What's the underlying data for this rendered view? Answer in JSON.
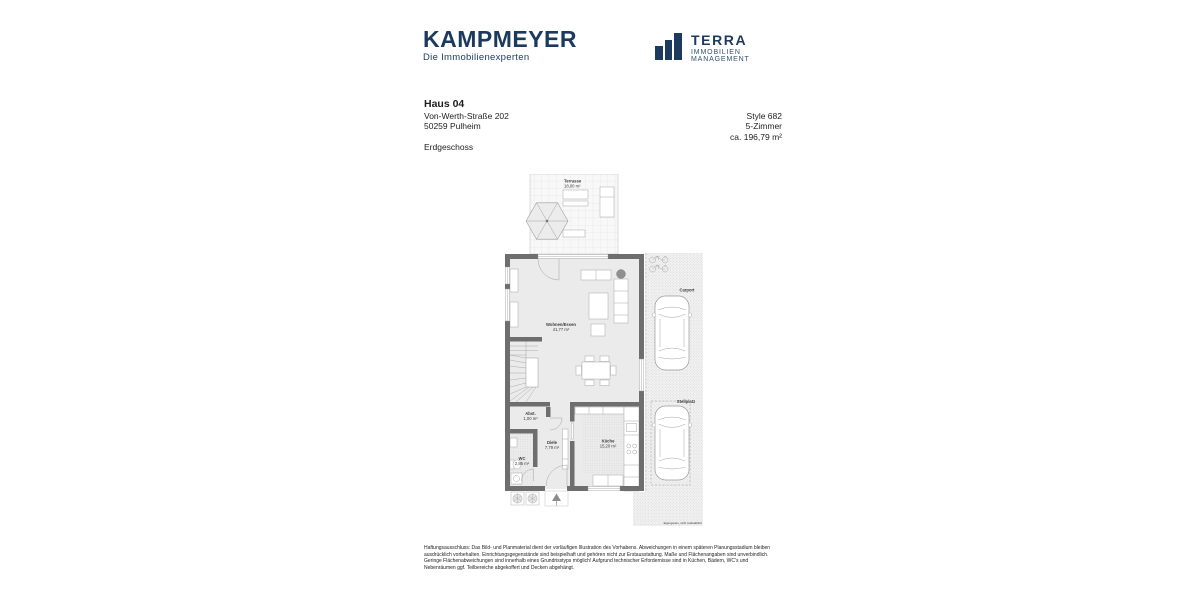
{
  "logos": {
    "kampmeyer": {
      "name": "KAMPMEYER",
      "tagline": "Die Immobilienexperten",
      "color": "#1c3a5e"
    },
    "terra": {
      "name": "TERRA",
      "subtitle": "IMMOBILIEN MANAGEMENT",
      "icon": "bar-chart-icon",
      "color": "#1c3a5e"
    }
  },
  "header": {
    "title": "Haus 04",
    "address_line1": "Von-Werth-Straße 202",
    "address_line2": "50259 Pulheim",
    "floor": "Erdgeschoss",
    "style": "Style 682",
    "rooms": "5-Zimmer",
    "area": "ca. 196,79 m²"
  },
  "floorplan": {
    "rooms": [
      {
        "name": "Terrasse",
        "area": "18,00 m²"
      },
      {
        "name": "Wohnen/Essen",
        "area": "41,77 m²"
      },
      {
        "name": "Abst.",
        "area": "1,00 m²"
      },
      {
        "name": "Diele",
        "area": "7,79 m²"
      },
      {
        "name": "WC",
        "area": "2,85 m²"
      },
      {
        "name": "Küche",
        "area": "15,20 m²"
      }
    ],
    "outdoor_labels": [
      "Carport",
      "Stellplatz"
    ],
    "caption": "Eigengarten, nicht maßstäblich",
    "icons": [
      "umbrella-icon",
      "car-icon",
      "bicycle-icon",
      "plant-icon",
      "entrance-arrow-icon"
    ]
  },
  "disclaimer": "Haftungsausschluss: Das Bild- und Planmaterial dient der vorläufigen Illustration des Vorhabens. Abweichungen in einem späteren Planungsstadium bleiben ausdrücklich vorbehalten. Einrichtungsgegenstände sind beispielhaft und gehören nicht zur Erstausstattung. Maße und Flächenangaben sind unverbindlich. Geringe Flächenabweichungen sind innerhalb eines Grundrisstyps möglich! Aufgrund technischer Erfordernisse sind in Küchen, Bädern, WC's und Nebenräumen ggf. Teilbereiche abgekoffert und Decken abgehängt."
}
